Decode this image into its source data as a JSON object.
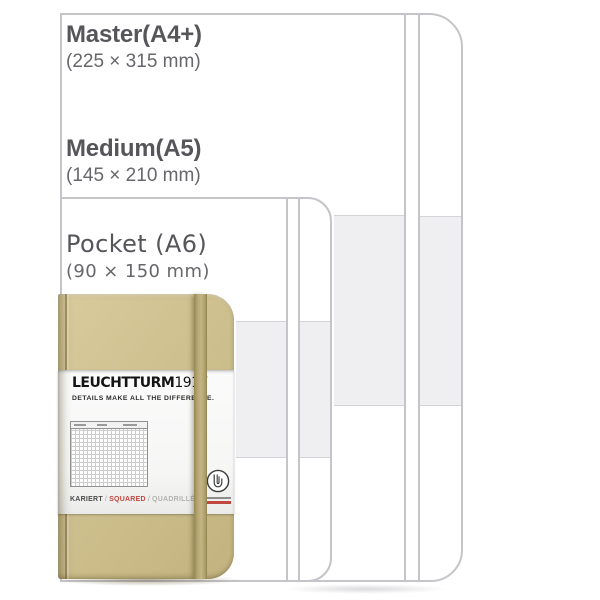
{
  "sizes": [
    {
      "name": "Master(A4+)",
      "dims": "(225 × 315 mm)"
    },
    {
      "name": "Medium(A5)",
      "dims": "(145 × 210 mm)"
    },
    {
      "name": "Pocket (A6)",
      "dims": "(90 × 150 mm)"
    }
  ],
  "band": {
    "brand": "LEUCHTTURM",
    "brand_year": "1917",
    "tagline": "DETAILS MAKE ALL THE DIFFERENCE.",
    "ruling_de": "KARIERT",
    "ruling_en": "SQUARED",
    "ruling_fr": "QUADRILLÉ",
    "separator": "/"
  },
  "colors": {
    "cover_tan": "#cdbf8d",
    "accent_red": "#c14741",
    "outline_gray": "#c5c5c9",
    "fill_gray": "#efeff1"
  }
}
